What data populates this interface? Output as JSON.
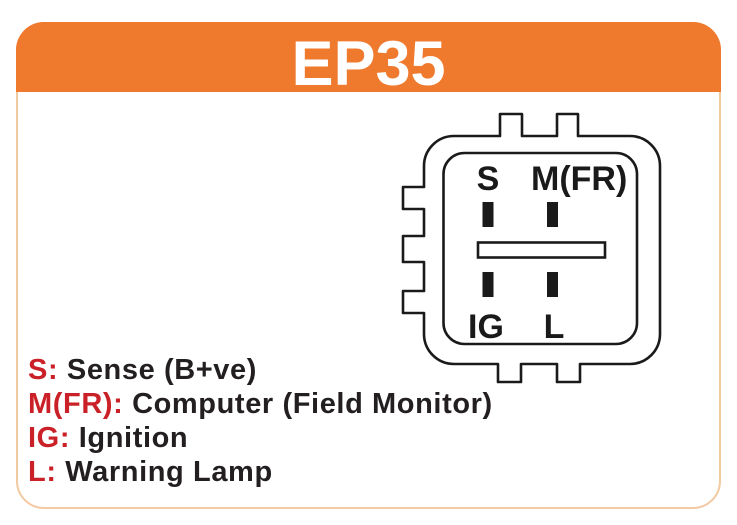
{
  "card": {
    "title": "EP35",
    "colors": {
      "header_bg": "#ef7a2e",
      "header_text": "#ffffff",
      "card_border": "#f2c9a0"
    }
  },
  "connector": {
    "stroke_color": "#1a1a1a",
    "pin_labels": {
      "top_left": "S",
      "top_right": "M(FR)",
      "bottom_left": "IG",
      "bottom_right": "L"
    }
  },
  "legend": {
    "label_color": "#c92127",
    "description_color": "#231f20",
    "items": [
      {
        "label": "S:",
        "description": "Sense (B+ve)"
      },
      {
        "label": "M(FR):",
        "description": "Computer (Field Monitor)"
      },
      {
        "label": "IG:",
        "description": "Ignition"
      },
      {
        "label": "L:",
        "description": "Warning Lamp"
      }
    ]
  }
}
